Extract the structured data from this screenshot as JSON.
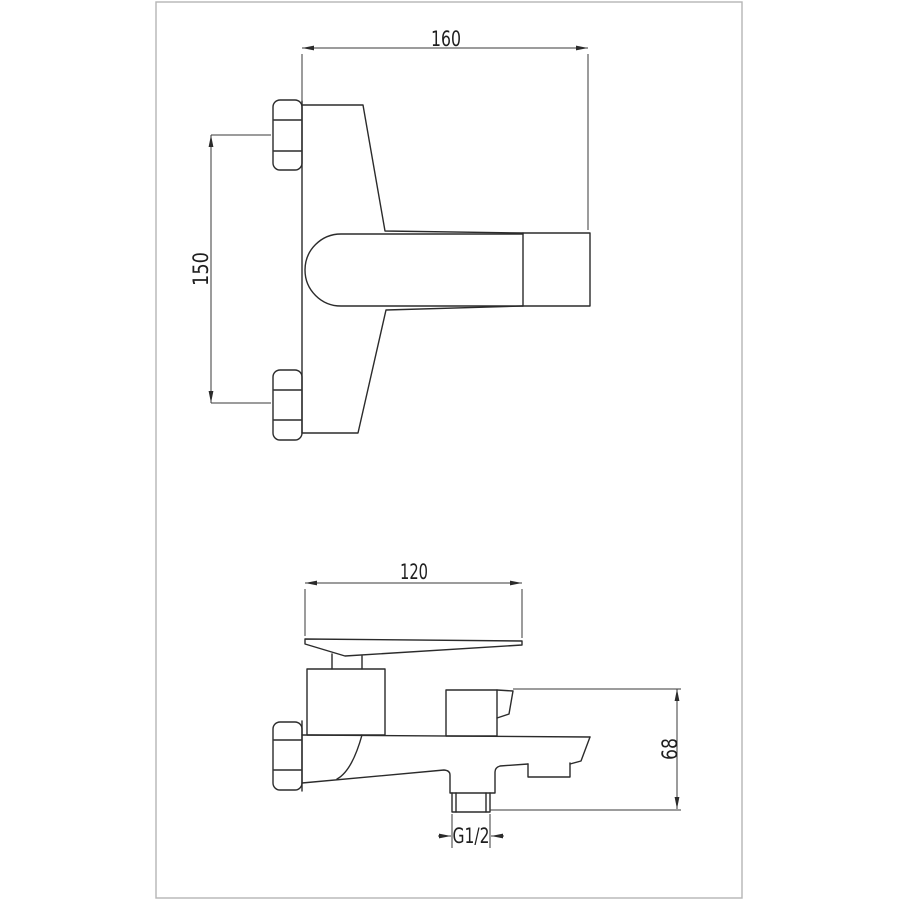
{
  "colors": {
    "background": "#ffffff",
    "frame": "#b5b5b5",
    "line": "#2b2b2b",
    "dim": "#3a3a3a",
    "text": "#1f1f1f"
  },
  "drawing": {
    "dims": {
      "spout_reach": "160",
      "inlet_center_distance": "150",
      "handle_length": "120",
      "body_height": "68",
      "outlet_thread": "G1/2"
    }
  }
}
